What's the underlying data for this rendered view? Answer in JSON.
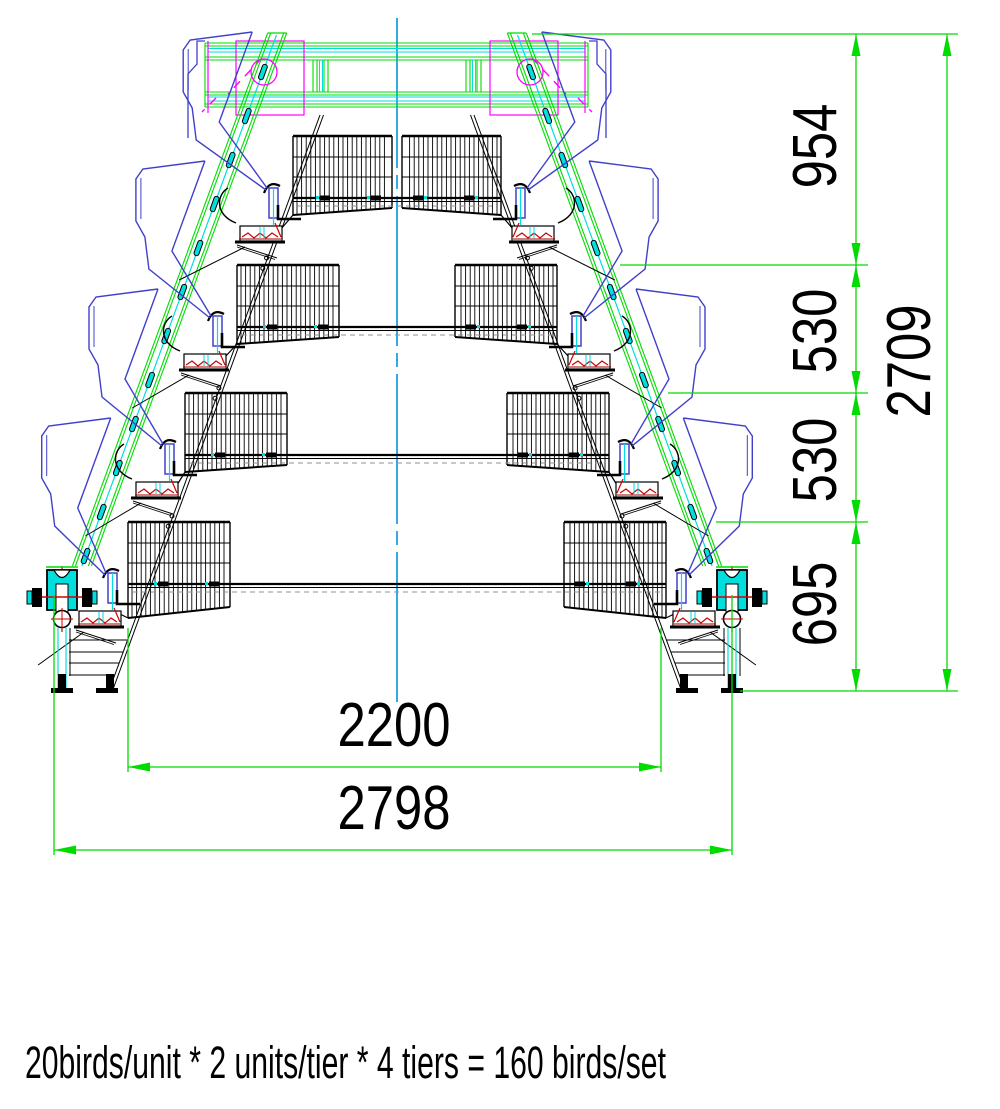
{
  "caption": "20birds/unit * 2 units/tier * 4 tiers = 160 birds/set",
  "dimensions": {
    "right_chain": [
      "954",
      "530",
      "530",
      "695"
    ],
    "overall_height": "2709",
    "inner_width": "2200",
    "overall_width": "2798"
  },
  "colors": {
    "dimension_green": "#00dc00",
    "detail_cyan": "#00dede",
    "hopper_blue": "#4040cc",
    "highlight_magenta": "#ff00ff",
    "centerline_blue": "#0095dc",
    "accent_red": "#d00000",
    "dark_red": "#a00000",
    "line_black": "#000000",
    "grey_dashed": "#909090",
    "background": "#ffffff"
  }
}
